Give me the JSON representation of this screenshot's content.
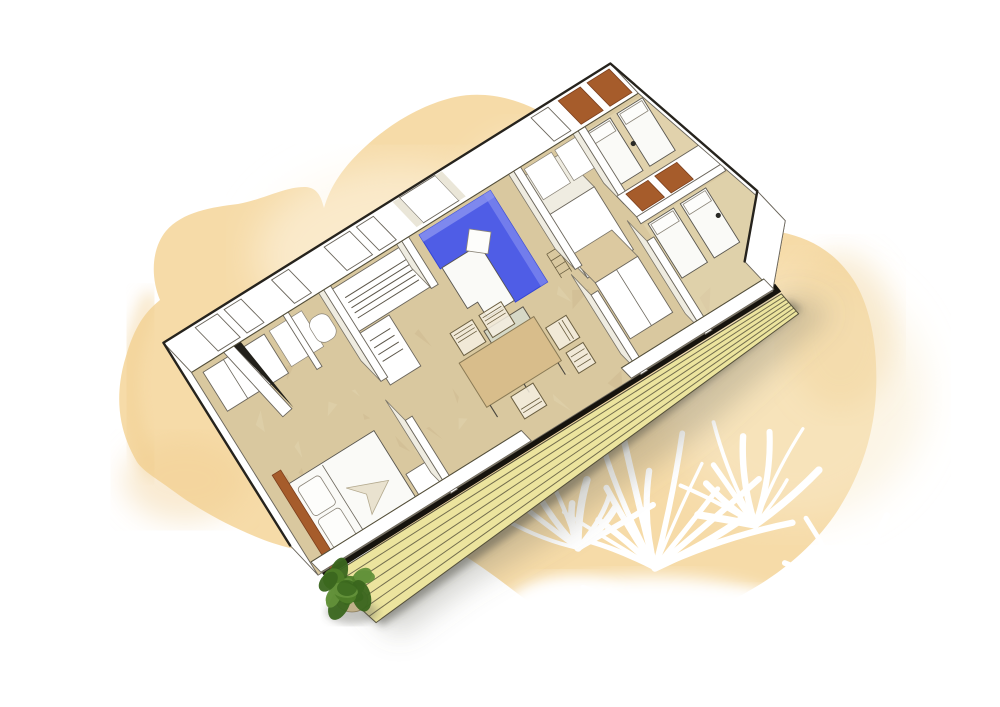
{
  "scene": {
    "description": "Sketch-style 3D cutaway floor plan of a rectangular mobile home with front wooden deck, drawn over a yellow watercolor wash with white palm-frond silhouettes and a green potted bush at the deck corner",
    "view": "rotated axonometric top-down cutaway",
    "rotation_deg": -32
  },
  "palette": {
    "bg": "#ffffff",
    "wash_main": "#f6d9a3",
    "wash_deep": "#f0cd8e",
    "wash_light": "#faeccd",
    "wash_pale": "#fdf6e8",
    "floor": "#d9c89f",
    "floor_light": "#e9ddb9",
    "floor_dark": "#c6b186",
    "wall_white": "#ffffff",
    "wall_shade": "#efece1",
    "wall_line": "#6b665c",
    "roof_line": "#26231d",
    "sofa_blue": "#4f5de6",
    "sofa_blue_light": "#8a93f0",
    "sofa_blue_dark": "#3345d4",
    "cushion_white": "#fafaf7",
    "headboard": "#a65c2b",
    "headboard_dark": "#7c3f1d",
    "table_wood": "#d8bd8b",
    "coffee_table_top": "#d6d8c6",
    "deck_plank": "#ece49e",
    "deck_gap": "#7a7250",
    "deck_edge": "#16130d",
    "shadow": "#6f6f68",
    "bush_greens": [
      "#4e7d28",
      "#63913a",
      "#3a661d"
    ],
    "pot": "#c0b089",
    "window_glow": "#f2d49e",
    "curtain": "#eae6d8"
  },
  "house": {
    "rooms": [
      "master-bedroom",
      "shower-room",
      "wc",
      "kitchen",
      "living-dining",
      "hallway-wardrobes",
      "kids-bedroom-back",
      "kids-bedroom-front"
    ],
    "furniture": [
      "double-bed",
      "bed-headboard",
      "wardrobe",
      "shower-tray",
      "toilet",
      "kitchen-counter",
      "kitchen-island",
      "corner-sofa",
      "sofa-pillow",
      "coffee-table",
      "dining-table",
      "dining-chairs-x4",
      "tall-cupboard-1",
      "tall-cupboard-2",
      "single-bed-1",
      "single-bed-2",
      "single-bed-3",
      "single-bed-4",
      "headboard-panels-x4",
      "nightstand"
    ],
    "window_count": 7,
    "open_door_wedge": 1
  },
  "deck": {
    "plank_gap_lines": 6,
    "edge": "black threshold band",
    "shadow": "soft gray blur below"
  },
  "decor": {
    "floor_speckles": {
      "count": 48,
      "seed": 9,
      "light": "#e9ddb9",
      "dark": "#c6b186",
      "min": 9,
      "max": 26,
      "area": [
        238,
        214,
        556,
        224
      ]
    },
    "frond_clusters": [
      {
        "cx": 655,
        "cy": 568,
        "a0": 200,
        "a1": 340,
        "count": 13,
        "len": 135,
        "seed": 3
      },
      {
        "cx": 578,
        "cy": 548,
        "a0": 200,
        "a1": 330,
        "count": 9,
        "len": 88,
        "seed": 5
      },
      {
        "cx": 755,
        "cy": 525,
        "a0": 195,
        "a1": 320,
        "count": 10,
        "len": 108,
        "seed": 7
      },
      {
        "cx": 852,
        "cy": 602,
        "a0": 210,
        "a1": 320,
        "count": 8,
        "len": 95,
        "seed": 11
      },
      {
        "cx": 640,
        "cy": 612,
        "a0": 160,
        "a1": 215,
        "count": 6,
        "len": 70,
        "seed": 13
      }
    ],
    "bush": {
      "cx": 347,
      "cy": 588,
      "leaves": 18,
      "seed": 21
    }
  }
}
